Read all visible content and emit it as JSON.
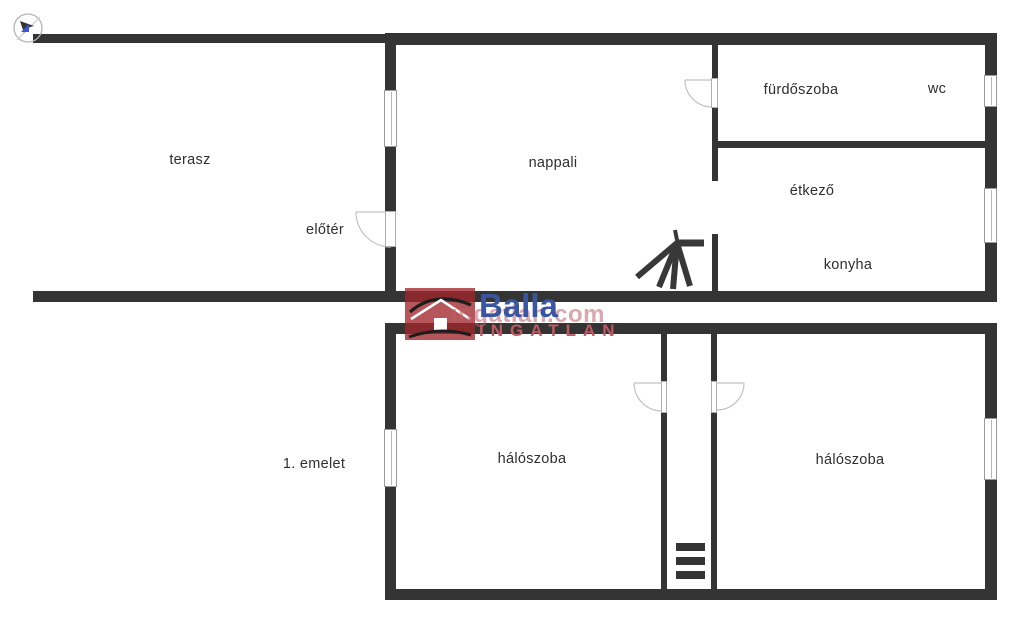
{
  "page": {
    "background": "#ffffff"
  },
  "colors": {
    "wall": "#343434",
    "door_arc": "#c2c2c2",
    "brand_blue": "#3a56a1",
    "brand_red": "#a3262c",
    "watermark_pink": "#c56a72",
    "compass_triangle_blue": "#3b55d6"
  },
  "floor_plan": {
    "upper": {
      "rooms": {
        "terasz": "terasz",
        "eloter": "előtér",
        "nappali": "nappali",
        "furdoszoba": "fürdőszoba",
        "wc": "wc",
        "etkezo": "étkező",
        "konyha": "konyha"
      }
    },
    "lower": {
      "floor_label": "1. emelet",
      "rooms": {
        "haloszoba_left": "hálószoba",
        "haloszoba_right": "hálószoba"
      }
    }
  },
  "watermark": {
    "brand": "Balla",
    "brand_sub": "INGATLAN",
    "site": "ingatlan.com"
  }
}
